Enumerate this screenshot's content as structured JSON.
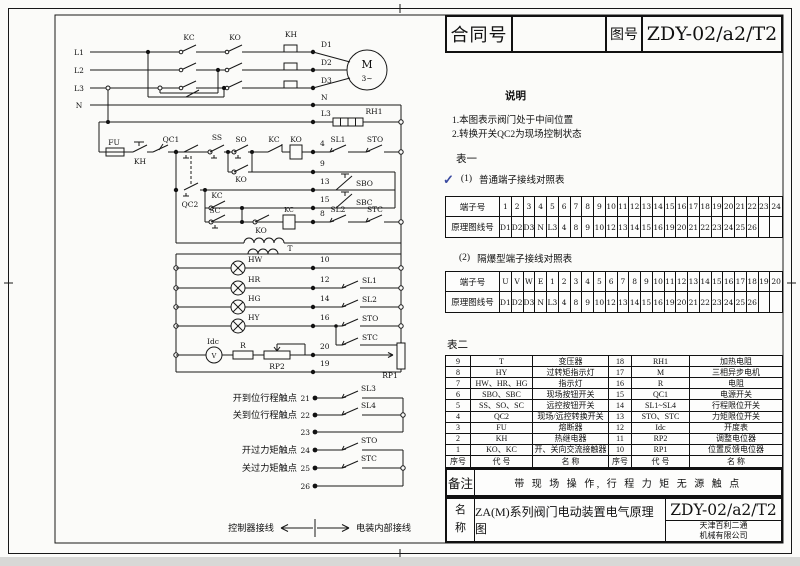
{
  "title_block": {
    "contract_label": "合同号",
    "contract_value": "",
    "drawing_no_label": "图号",
    "drawing_no": "ZDY-02/a2/T2",
    "notes_title": "说明",
    "note1": "1.本图表示阀门处于中间位置",
    "note2": "2.转换开关QC2为现场控制状态",
    "table1_title": "表一",
    "check_mark": "✓",
    "sub1_no": "(1)",
    "sub1_text": "普通端子接线对照表",
    "sub2_no": "(2)",
    "sub2_text": "隔爆型端子接线对照表",
    "table2_title": "表二",
    "remark_label": "备注",
    "remark_text": "带 现 场 操 作, 行 程 力 矩 无 源 触 点",
    "name_label": "名称",
    "name_value": "ZA(M)系列阀门电动装置电气原理图",
    "drawing_no_bottom": "ZDY-02/a2/T2",
    "company": [
      "天津百利二通",
      "机械有限公司"
    ]
  },
  "terminal_tables": {
    "row_label_terminal": "端子号",
    "row_label_wire": "原理图线号",
    "ordinary": {
      "terminals": [
        "1",
        "2",
        "3",
        "4",
        "5",
        "6",
        "7",
        "8",
        "9",
        "10",
        "11",
        "12",
        "13",
        "14",
        "15",
        "16",
        "17",
        "18",
        "19",
        "20",
        "21",
        "22",
        "23",
        "24"
      ],
      "wires": [
        "D1",
        "D2",
        "D3",
        "N",
        "L3",
        "4",
        "8",
        "9",
        "10",
        "12",
        "13",
        "14",
        "15",
        "16",
        "19",
        "20",
        "21",
        "22",
        "23",
        "24",
        "25",
        "26",
        "",
        ""
      ]
    },
    "explosion_proof": {
      "terminals": [
        "U",
        "V",
        "W",
        "E",
        "1",
        "2",
        "3",
        "4",
        "5",
        "6",
        "7",
        "8",
        "9",
        "10",
        "11",
        "12",
        "13",
        "14",
        "15",
        "16",
        "17",
        "18",
        "19",
        "20"
      ],
      "wires": [
        "D1",
        "D2",
        "D3",
        "N",
        "L3",
        "4",
        "8",
        "9",
        "10",
        "12",
        "13",
        "14",
        "15",
        "16",
        "19",
        "20",
        "21",
        "22",
        "23",
        "24",
        "25",
        "26",
        "",
        ""
      ]
    }
  },
  "component_table": {
    "headers": [
      "序号",
      "代 号",
      "名 称",
      "序号",
      "代 号",
      "名 称"
    ],
    "rows": [
      [
        "9",
        "T",
        "变压器",
        "18",
        "RH1",
        "加热电阻"
      ],
      [
        "8",
        "HY",
        "过转矩指示灯",
        "17",
        "M",
        "三相异步电机"
      ],
      [
        "7",
        "HW、HR、HG",
        "指示灯",
        "16",
        "R",
        "电阻"
      ],
      [
        "6",
        "SBO、SBC",
        "现场按钮开关",
        "15",
        "QC1",
        "电源开关"
      ],
      [
        "5",
        "SS、SO、SC",
        "远控按钮开关",
        "14",
        "SL1~SL4",
        "行程限位开关"
      ],
      [
        "4",
        "QC2",
        "现场/远控转换开关",
        "13",
        "STO、STC",
        "力矩限位开关"
      ],
      [
        "3",
        "FU",
        "熔断器",
        "12",
        "Idc",
        "开度表"
      ],
      [
        "2",
        "KH",
        "热继电器",
        "11",
        "RP2",
        "调整电位器"
      ],
      [
        "1",
        "KO、KC",
        "开、关向交流接触器",
        "10",
        "RP1",
        "位置反馈电位器"
      ]
    ]
  },
  "circuit": {
    "labels": {
      "l1": "L1",
      "l2": "L2",
      "l3": "L3",
      "n": "N",
      "kc": "KC",
      "ko": "KO",
      "kh": "KH",
      "d1": "D1",
      "d2": "D2",
      "d3": "D3",
      "rh1": "RH1",
      "m": "M",
      "phase": "3~",
      "fu": "FU",
      "qc1": "QC1",
      "qc2": "QC2",
      "ss": "SS",
      "so": "SO",
      "sc": "SC",
      "sbo": "SBO",
      "sbc": "SBC",
      "sl1": "SL1",
      "sl2": "SL2",
      "sl3": "SL3",
      "sl4": "SL4",
      "sto": "STO",
      "stc": "STC",
      "t": "T",
      "hw": "HW",
      "hr": "HR",
      "hg": "HG",
      "hy": "HY",
      "idc": "Idc",
      "r": "R",
      "rp1": "RP1",
      "rp2": "RP2",
      "vmeter": "V",
      "n4": "4",
      "n8": "8",
      "n9": "9",
      "n10": "10",
      "n12": "12",
      "n13": "13",
      "n14": "14",
      "n15": "15",
      "n16": "16",
      "n19": "19",
      "n20": "20",
      "n21": "21",
      "n22": "22",
      "n23": "23",
      "n24": "24",
      "n25": "25",
      "n26": "26",
      "open_travel": "开到位行程触点",
      "close_travel": "关到位行程触点",
      "open_torque": "开过力矩触点",
      "close_torque": "关过力矩触点",
      "ctrl_wiring": "控制器接线",
      "internal_wiring": "电装内部接线"
    }
  },
  "colors": {
    "check_mark": "#3a4aa0",
    "line": "#181818"
  }
}
